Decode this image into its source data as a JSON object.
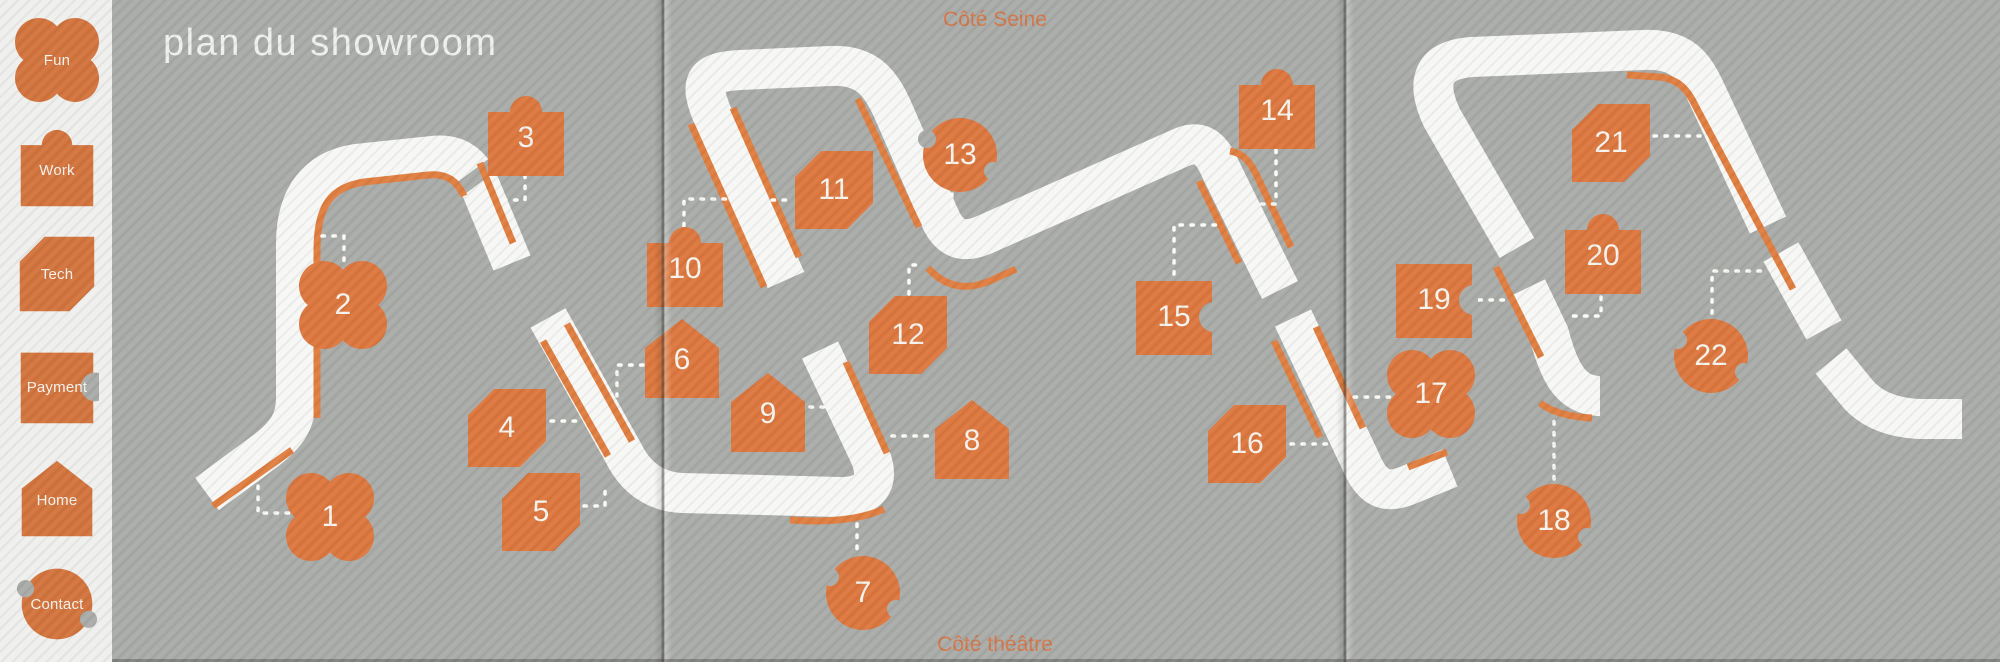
{
  "title": "plan du showroom",
  "edge_labels": {
    "top": "Côté Seine",
    "bottom": "Côté théâtre"
  },
  "sidebar": {
    "items": [
      {
        "label": "Fun",
        "category": "fun",
        "y": 18
      },
      {
        "label": "Work",
        "category": "work",
        "y": 128
      },
      {
        "label": "Tech",
        "category": "tech",
        "y": 232
      },
      {
        "label": "Payment",
        "category": "payment",
        "y": 345
      },
      {
        "label": "Home",
        "category": "home",
        "y": 458
      },
      {
        "label": "Contact",
        "category": "contact",
        "y": 562
      }
    ]
  },
  "map": {
    "stations": [
      {
        "n": "1",
        "category": "fun",
        "x": 330,
        "y": 517
      },
      {
        "n": "2",
        "category": "fun",
        "x": 343,
        "y": 305
      },
      {
        "n": "3",
        "category": "work",
        "x": 526,
        "y": 138
      },
      {
        "n": "4",
        "category": "tech",
        "x": 507,
        "y": 428
      },
      {
        "n": "5",
        "category": "tech",
        "x": 541,
        "y": 512
      },
      {
        "n": "6",
        "category": "home",
        "x": 682,
        "y": 360
      },
      {
        "n": "7",
        "category": "contact",
        "x": 863,
        "y": 593
      },
      {
        "n": "8",
        "category": "home",
        "x": 972,
        "y": 441
      },
      {
        "n": "9",
        "category": "home",
        "x": 768,
        "y": 414
      },
      {
        "n": "10",
        "category": "work",
        "x": 685,
        "y": 269
      },
      {
        "n": "11",
        "category": "tech",
        "x": 834,
        "y": 190
      },
      {
        "n": "12",
        "category": "tech",
        "x": 908,
        "y": 335
      },
      {
        "n": "13",
        "category": "contact",
        "x": 960,
        "y": 155
      },
      {
        "n": "14",
        "category": "work",
        "x": 1277,
        "y": 111
      },
      {
        "n": "15",
        "category": "payment",
        "x": 1174,
        "y": 317
      },
      {
        "n": "16",
        "category": "tech",
        "x": 1247,
        "y": 444
      },
      {
        "n": "17",
        "category": "fun",
        "x": 1431,
        "y": 394
      },
      {
        "n": "18",
        "category": "contact",
        "x": 1554,
        "y": 521
      },
      {
        "n": "19",
        "category": "payment",
        "x": 1434,
        "y": 300
      },
      {
        "n": "20",
        "category": "work",
        "x": 1603,
        "y": 256
      },
      {
        "n": "21",
        "category": "tech",
        "x": 1611,
        "y": 143
      },
      {
        "n": "22",
        "category": "contact",
        "x": 1711,
        "y": 356
      }
    ]
  },
  "colors": {
    "orange": "#dc7840",
    "accent_orange": "#e07f42",
    "path_white": "#f7f8f5",
    "map_gray": "#aaaca9",
    "sidebar_bg": "#eff0ee"
  }
}
